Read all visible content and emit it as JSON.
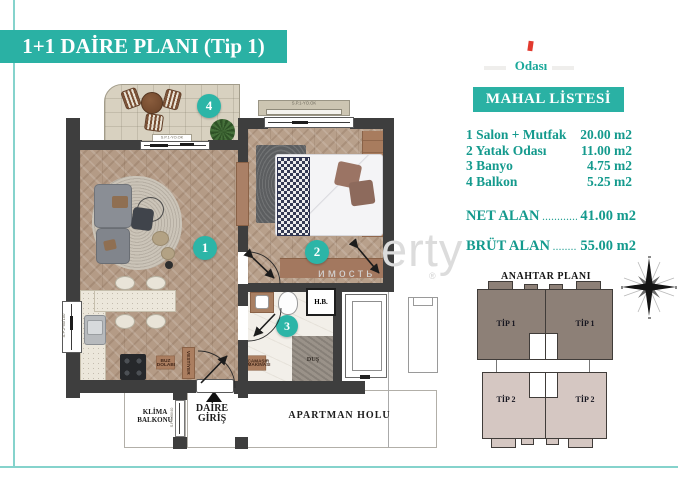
{
  "title": "1+1 DAİRE PLANI (Tip 1)",
  "side": {
    "odasi": "Odası",
    "mahal_header": "MAHAL LİSTESİ",
    "rooms": [
      {
        "no": "1",
        "name": "1 Salon + Mutfak",
        "area": "20.00 m2"
      },
      {
        "no": "2",
        "name": "2 Yatak Odası",
        "area": "11.00 m2"
      },
      {
        "no": "3",
        "name": "3 Banyo",
        "area": "4.75 m2"
      },
      {
        "no": "4",
        "name": "4 Balkon",
        "area": "5.25 m2"
      }
    ],
    "net": {
      "label": "NET ALAN",
      "leader": "..................",
      "value": "41.00 m2"
    },
    "brut": {
      "label": "BRÜT ALAN",
      "leader": "..............",
      "value": "55.00 m2"
    }
  },
  "keyplan": {
    "title": "ANAHTAR PLANI",
    "units": [
      "TİP 1",
      "TİP 1",
      "TİP 2",
      "TİP 2"
    ],
    "colors": {
      "tip1_fill": "#8d8077",
      "tip2_fill": "#d5c7c2"
    }
  },
  "plan": {
    "badges": [
      "1",
      "2",
      "3",
      "4"
    ],
    "labels": {
      "klima_line1": "KLİMA",
      "klima_line2": "BALKONU",
      "daire_line1": "DAİRE",
      "daire_line2": "GİRİŞ",
      "apartman": "APARTMAN HOLU",
      "hb": "H.B.",
      "dus": "DUŞ",
      "buz_line1": "BUZ",
      "buz_line2": "DOLABI",
      "vestiyer": "VESTİYER",
      "camasir_line1": "ÇAMAŞIR",
      "camasir_line2": "MAKİNASI"
    },
    "window_tags": {
      "sp1": "S.P.1-YO.OK",
      "sp2": "S.P.2-50/100",
      "sp3": "S.P.3-90/40"
    }
  },
  "watermark": {
    "big": "erty",
    "small": "имость",
    "reg": "®"
  },
  "colors": {
    "accent_teal": "#2ab1a4",
    "badge_teal": "#2cb5a7",
    "list_teal": "#149a8d",
    "frame_line": "#85d3cc",
    "wall": "#3e3e3e",
    "wood_floor": "#b49b86",
    "red_mark": "#e23a2e",
    "cabinet_brown": "#ab7e60"
  }
}
